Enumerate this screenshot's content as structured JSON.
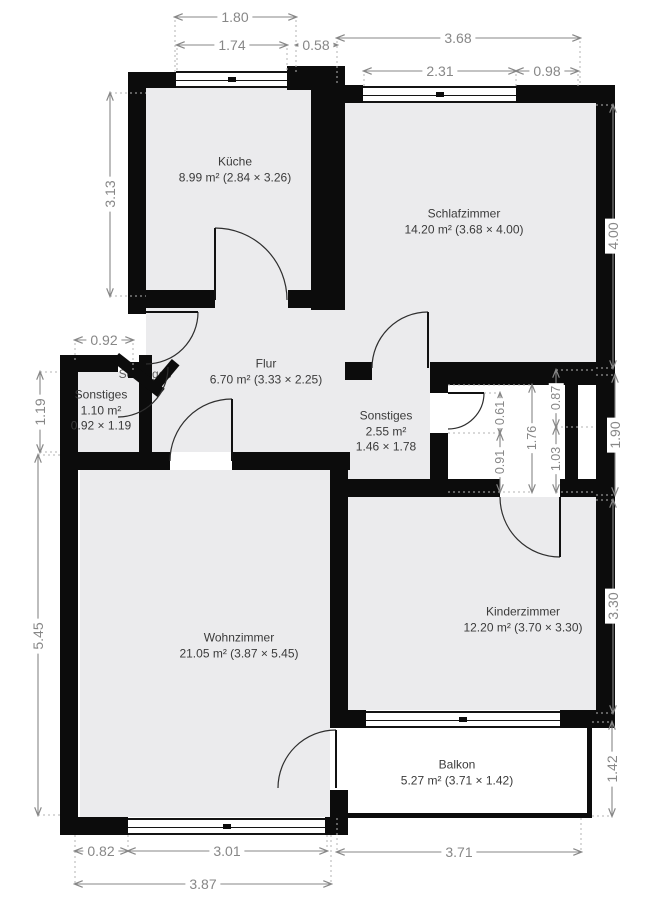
{
  "plan": {
    "rooms": {
      "kueche": {
        "name": "Küche",
        "area": "8.99 m² (2.84 × 3.26)"
      },
      "schlafzimmer": {
        "name": "Schlafzimmer",
        "area": "14.20 m² (3.68 × 4.00)"
      },
      "flur": {
        "name": "Flur",
        "area": "6.70 m² (3.33 × 2.25)"
      },
      "sonstiges1": {
        "name": "Sonstiges",
        "area": "1.10 m²",
        "dims": "0.92 × 1.19"
      },
      "sonstiges2": {
        "name": "Sonstiges",
        "area": "2.55 m²",
        "dims": "1.46 × 1.78"
      },
      "wohnzimmer": {
        "name": "Wohnzimmer",
        "area": "21.05 m² (3.87 × 5.45)"
      },
      "kinderzimmer": {
        "name": "Kinderzimmer",
        "area": "12.20 m² (3.70 × 3.30)"
      },
      "balkon": {
        "name": "Balkon",
        "area": "5.27 m² (3.71 × 1.42)"
      },
      "hidden": {
        "name": "Sonstiges"
      }
    },
    "dimensions": {
      "top": {
        "d180": "1.80",
        "d174": "1.74",
        "d058": "0.58",
        "d368": "3.68",
        "d231": "2.31",
        "d098": "0.98"
      },
      "left": {
        "d313": "3.13",
        "d092": "0.92",
        "d119": "1.19",
        "d545": "5.45"
      },
      "right": {
        "d400": "4.00",
        "d190": "1.90",
        "d330": "3.30",
        "d142": "1.42"
      },
      "bottom": {
        "d082": "0.82",
        "d301": "3.01",
        "d387": "3.87",
        "d371": "3.71"
      },
      "inner": {
        "d061": "0.61",
        "d091": "0.91",
        "d176": "1.76",
        "d087": "0.87",
        "d103": "1.03"
      }
    },
    "colors": {
      "wall": "#0c0c0c",
      "room_fill": "#ebebed",
      "dimension": "#878787",
      "background": "#ffffff"
    }
  }
}
